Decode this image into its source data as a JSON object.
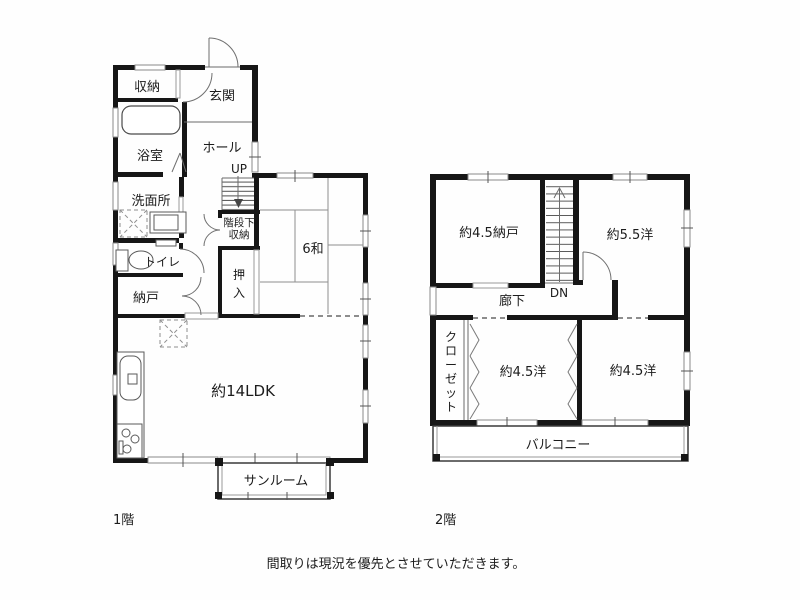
{
  "caption": "間取りは現況を優先とさせていただきます。",
  "colors": {
    "wall": "#161616",
    "line": "#6b6b6b",
    "window": "#8a8a8a",
    "background": "#fefefe"
  },
  "floor1": {
    "label": "1階",
    "rooms": {
      "shuno": "収納",
      "genkan": "玄関",
      "yokushitsu": "浴室",
      "hall": "ホール",
      "up": "UP",
      "senmenjo": "洗面所",
      "kaidanshita_line1": "階段下",
      "kaidanshita_line2": "収納",
      "toilet": "トイレ",
      "nando": "納戸",
      "oshiire": [
        "押",
        "入"
      ],
      "washitsu": "6和",
      "ldk": "約14LDK",
      "sunroom": "サンルーム"
    }
  },
  "floor2": {
    "label": "2階",
    "rooms": {
      "nando45": "約4.5納戸",
      "dn": "DN",
      "yo55": "約5.5洋",
      "roka": "廊下",
      "closet": [
        "ク",
        "ロ",
        "ー",
        "ゼ",
        "ッ",
        "ト"
      ],
      "yo45_left": "約4.5洋",
      "yo45_right": "約4.5洋",
      "balcony": "バルコニー"
    }
  }
}
